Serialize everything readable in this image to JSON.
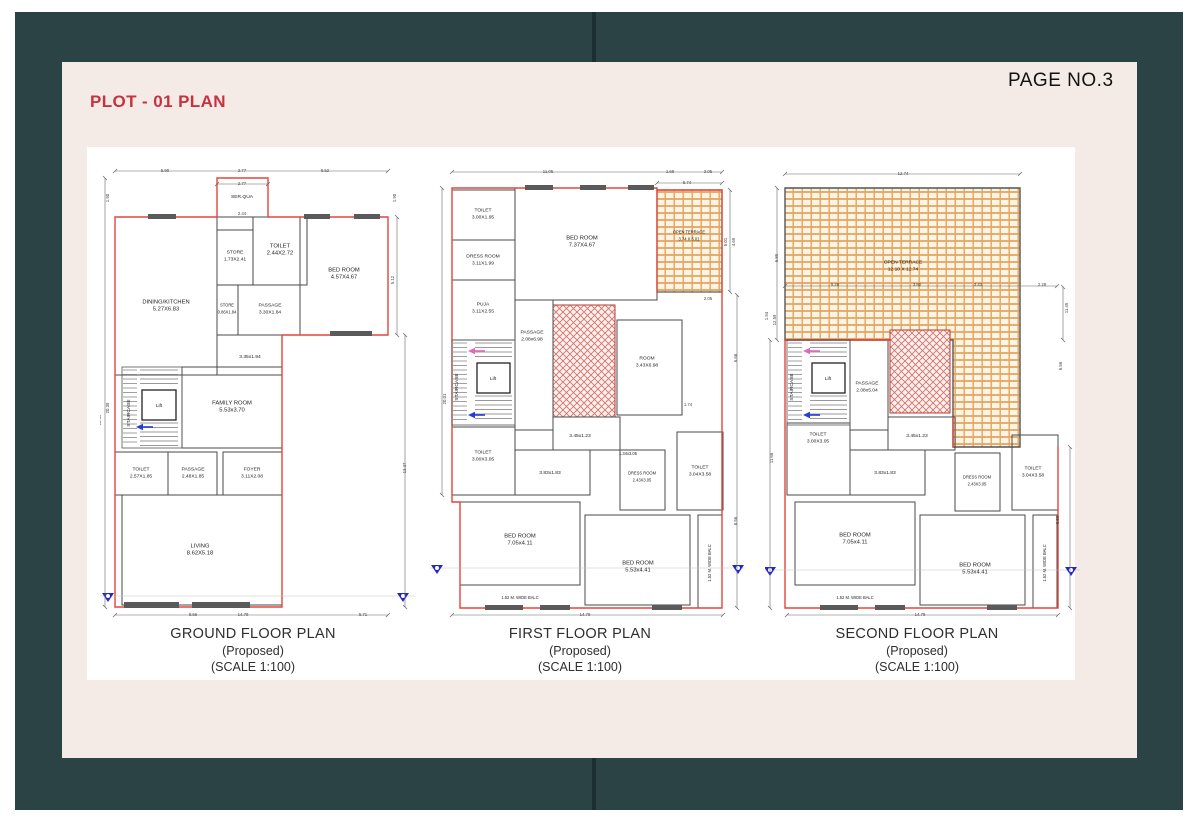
{
  "page": {
    "title": "PLOT - 01 PLAN",
    "page_no": "PAGE NO.3",
    "colors": {
      "frame_teal": "#2b4345",
      "fold_dark": "#1b2f30",
      "sheet_pink": "#f4ebe7",
      "panel_white": "#ffffff",
      "accent_red": "#c8313e",
      "plan_red": "#e0473d",
      "wall_gray": "#4a4a4a",
      "terrace_orange": "#e3a55e",
      "hatch_red": "#d3736b",
      "marker_blue": "#2228c8"
    }
  },
  "plans": [
    {
      "id": "ground-floor",
      "caption": [
        "GROUND FLOOR PLAN",
        "(Proposed)",
        "(SCALE 1:100)"
      ],
      "rooms": [
        {
          "label": "SER.QUA",
          "size": ""
        },
        {
          "label": "DINING/KITCHEN",
          "size": "5.27X6.83"
        },
        {
          "label": "STORE",
          "size": "1.73X2.41"
        },
        {
          "label": "TOILET",
          "size": "2.44X2.72"
        },
        {
          "label": "BED ROOM",
          "size": "4.57X4.67"
        },
        {
          "label": "STORE",
          "size": "0.86X1.84"
        },
        {
          "label": "PASSAGE",
          "size": "3.30X1.84"
        },
        {
          "label": "",
          "size": "3.35x1.94"
        },
        {
          "label": "FAMILY ROOM",
          "size": "5.53x3.70"
        },
        {
          "label": "Lift",
          "size": ""
        },
        {
          "label": "STAIRCASE",
          "size": ""
        },
        {
          "label": "TOILET",
          "size": "2.57X1.85"
        },
        {
          "label": "PASSAGE",
          "size": "2.48X1.85"
        },
        {
          "label": "FOYER",
          "size": "3.11X2.08"
        },
        {
          "label": "LIVING",
          "size": "8.62X5.18"
        }
      ],
      "dims": [
        "5.90",
        "2.77",
        "6.52",
        "2.77",
        "2.44",
        "1.90",
        "20.39",
        "18.49",
        "1.90",
        "5.12",
        "13.37",
        "8.66",
        "14.79",
        "5.71"
      ]
    },
    {
      "id": "first-floor",
      "caption": [
        "FIRST FLOOR PLAN",
        "(Proposed)",
        "(SCALE 1:100)"
      ],
      "rooms": [
        {
          "label": "TOILET",
          "size": "3.00X1.95"
        },
        {
          "label": "DRESS ROOM",
          "size": "3.11X1.99"
        },
        {
          "label": "PUJA",
          "size": "3.11X2.55"
        },
        {
          "label": "BED ROOM",
          "size": "7.37X4.67"
        },
        {
          "label": "OPEN TERRACE",
          "size": "3.74 X 5.01"
        },
        {
          "label": "PASSAGE",
          "size": "2.08x6.98"
        },
        {
          "label": "ROOM",
          "size": "3.43X6.98"
        },
        {
          "label": "Lift",
          "size": ""
        },
        {
          "label": "STAIRCASE",
          "size": ""
        },
        {
          "label": "TOILET",
          "size": "3.00X3.05"
        },
        {
          "label": "",
          "size": "3.45x1.23"
        },
        {
          "label": "",
          "size": "3.83x1.83"
        },
        {
          "label": "",
          "size": "1.34x3.05"
        },
        {
          "label": "DRESS ROOM",
          "size": "2.43X3.05"
        },
        {
          "label": "TOILET",
          "size": "3.04X3.58"
        },
        {
          "label": "BED ROOM",
          "size": "7.05x4.11"
        },
        {
          "label": "BED ROOM",
          "size": "5.53x4.41"
        },
        {
          "label": "1.52 M. WIDE BALC",
          "size": ""
        },
        {
          "label": "1.52 M. WIDE BALC",
          "size": ""
        }
      ],
      "dims": [
        "11.05",
        "1.69",
        "2.05",
        "5.74",
        "20.01",
        "5.01",
        "4.69",
        "2.05",
        "1.74",
        "6.56",
        "8.56",
        "14.79"
      ]
    },
    {
      "id": "second-floor",
      "caption": [
        "SECOND FLOOR PLAN",
        "(Proposed)",
        "(SCALE 1:100)"
      ],
      "rooms": [
        {
          "label": "OPEN TERRACE",
          "size": "12.10 X 12.74"
        },
        {
          "label": "PASSAGE",
          "size": "2.08x5.04"
        },
        {
          "label": "Lift",
          "size": ""
        },
        {
          "label": "STAIRCASE",
          "size": ""
        },
        {
          "label": "TOILET",
          "size": "3.00X3.05"
        },
        {
          "label": "",
          "size": "3.45x1.23"
        },
        {
          "label": "",
          "size": "3.83x1.83"
        },
        {
          "label": "DRESS ROOM",
          "size": "2.43X3.05"
        },
        {
          "label": "TOILET",
          "size": "3.04X3.58"
        },
        {
          "label": "BED ROOM",
          "size": "7.05x4.11"
        },
        {
          "label": "BED ROOM",
          "size": "5.53x4.41"
        },
        {
          "label": "1.52 M. WIDE BALC",
          "size": ""
        },
        {
          "label": "1.52 M. WIDE BALC",
          "size": ""
        }
      ],
      "dims": [
        "12.74",
        "5.28",
        "3.80",
        "3.43",
        "2.28",
        "6.89",
        "1.94",
        "12.59",
        "15.12",
        "11.66",
        "11.45",
        "6.56",
        "8.56",
        "14.79"
      ]
    }
  ]
}
